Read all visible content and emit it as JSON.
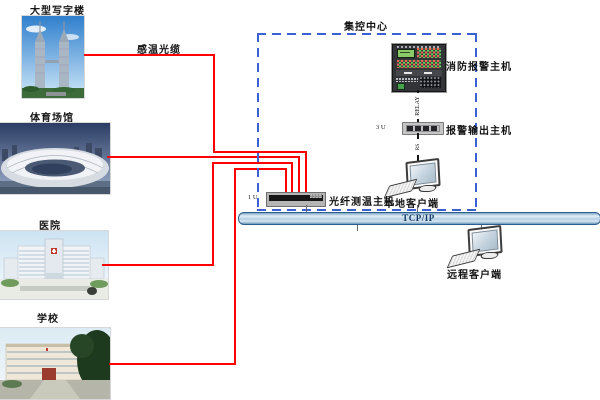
{
  "diagram": {
    "center_title": "集控中心",
    "cable_label": "感温光缆",
    "bus_label": "TCP/IP",
    "buildings": [
      {
        "label": "大型写字楼"
      },
      {
        "label": "体育场馆"
      },
      {
        "label": "医院"
      },
      {
        "label": "学校"
      }
    ],
    "devices": {
      "fire_alarm_host": "消防报警主机",
      "alarm_output_host": "报警输出主机",
      "alarm_output_size": "3 U",
      "fiber_host": "光纤测温主机",
      "fiber_host_size": "1 U",
      "local_client": "本地客户端",
      "remote_client": "远程客户端"
    },
    "links": {
      "relay": "RELAY",
      "serial": "RS"
    },
    "colors": {
      "cable": "#ff0000",
      "dashed": "#3b62d4",
      "bus_border": "#2e5e8e",
      "bus_text": "#173a66"
    }
  }
}
